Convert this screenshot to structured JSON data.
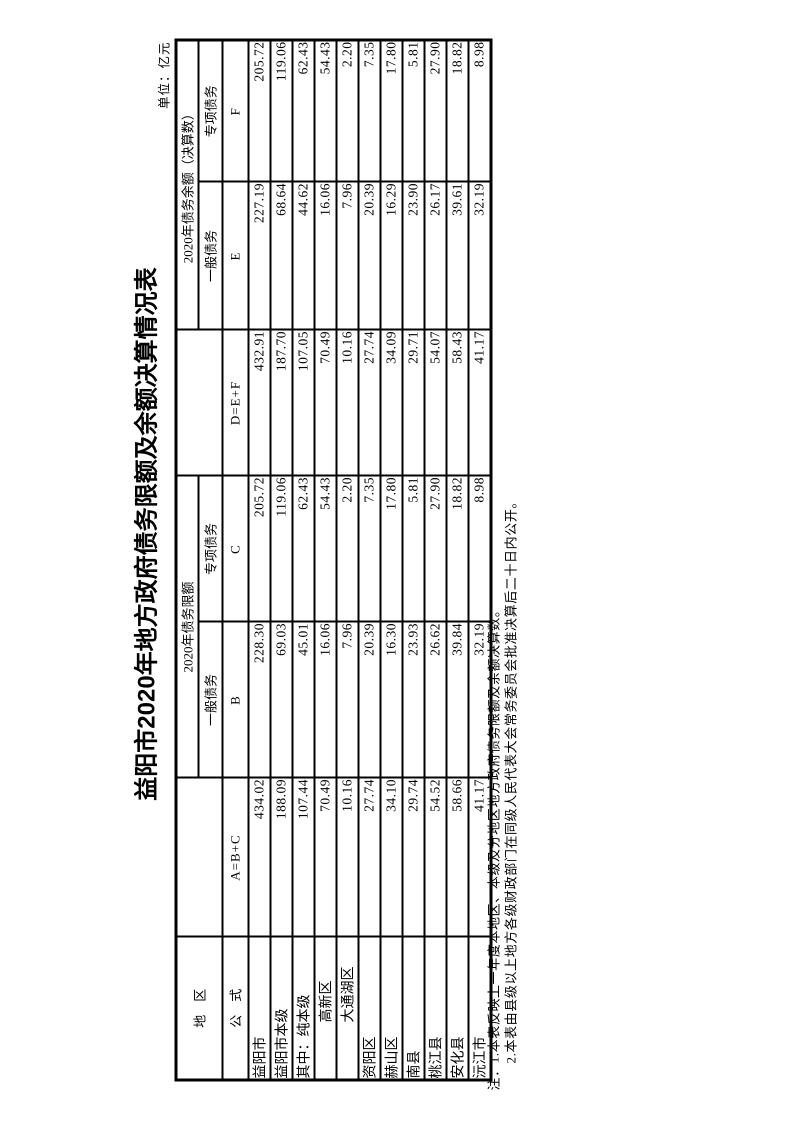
{
  "page": {
    "title": "益阳市2020年地方政府债务限额及余额决算情况表",
    "unit_label": "单位：亿元"
  },
  "table": {
    "header": {
      "region_label": "地　区",
      "formula_label": "公　式",
      "limit_group_label": "2020年债务限额",
      "balance_group_label": "2020年债务余额（决算数）",
      "general_debt_label": "一般债务",
      "special_debt_label": "专项债务",
      "formulas": {
        "total_limit": "A=B+C",
        "general_limit": "B",
        "special_limit": "C",
        "total_balance": "D=E+F",
        "general_balance": "E",
        "special_balance": "F"
      }
    },
    "rows": [
      {
        "region": "益阳市",
        "indent": false,
        "a": "434.02",
        "b": "228.30",
        "c": "205.72",
        "d": "432.91",
        "e": "227.19",
        "f": "205.72"
      },
      {
        "region": "益阳市本级",
        "indent": false,
        "a": "188.09",
        "b": "69.03",
        "c": "119.06",
        "d": "187.70",
        "e": "68.64",
        "f": "119.06"
      },
      {
        "region": "其中：纯本级",
        "indent": false,
        "a": "107.44",
        "b": "45.01",
        "c": "62.43",
        "d": "107.05",
        "e": "44.62",
        "f": "62.43"
      },
      {
        "region": "高新区",
        "indent": true,
        "a": "70.49",
        "b": "16.06",
        "c": "54.43",
        "d": "70.49",
        "e": "16.06",
        "f": "54.43"
      },
      {
        "region": "大通湖区",
        "indent": true,
        "a": "10.16",
        "b": "7.96",
        "c": "2.20",
        "d": "10.16",
        "e": "7.96",
        "f": "2.20"
      },
      {
        "region": "资阳区",
        "indent": false,
        "a": "27.74",
        "b": "20.39",
        "c": "7.35",
        "d": "27.74",
        "e": "20.39",
        "f": "7.35"
      },
      {
        "region": "赫山区",
        "indent": false,
        "a": "34.10",
        "b": "16.30",
        "c": "17.80",
        "d": "34.09",
        "e": "16.29",
        "f": "17.80"
      },
      {
        "region": "南县",
        "indent": false,
        "a": "29.74",
        "b": "23.93",
        "c": "5.81",
        "d": "29.71",
        "e": "23.90",
        "f": "5.81"
      },
      {
        "region": "桃江县",
        "indent": false,
        "a": "54.52",
        "b": "26.62",
        "c": "27.90",
        "d": "54.07",
        "e": "26.17",
        "f": "27.90"
      },
      {
        "region": "安化县",
        "indent": false,
        "a": "58.66",
        "b": "39.84",
        "c": "18.82",
        "d": "58.43",
        "e": "39.61",
        "f": "18.82"
      },
      {
        "region": "沅江市",
        "indent": false,
        "a": "41.17",
        "b": "32.19",
        "c": "8.98",
        "d": "41.17",
        "e": "32.19",
        "f": "8.98"
      }
    ],
    "notes": [
      "注：1.本表反映上一年度本地区、本级及分地区地方政府债务限额及余额决算数。",
      "2.本表由县级以上地方各级财政部门在同级人民代表大会常务委员会批准决算后二十日内公开。"
    ]
  }
}
